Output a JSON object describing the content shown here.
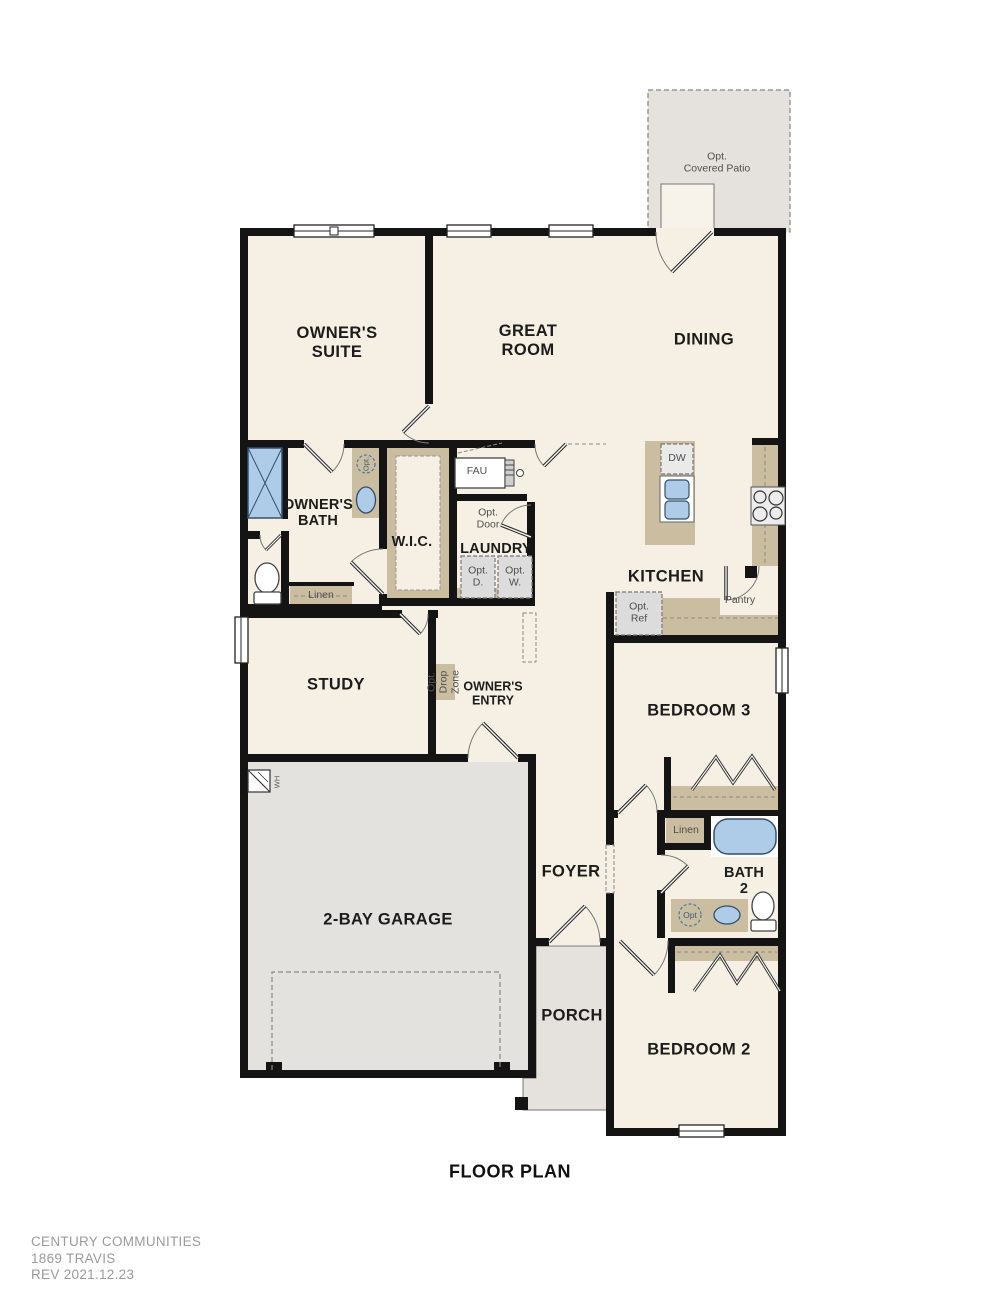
{
  "title": {
    "floor_plan": "FLOOR PLAN"
  },
  "footer": {
    "company": "CENTURY COMMUNITIES",
    "plan": "1869 TRAVIS",
    "rev": "REV  2021.12.23"
  },
  "rooms": {
    "patio": "Opt.\nCovered Patio",
    "owners_suite": "OWNER'S\nSUITE",
    "great_room": "GREAT\nROOM",
    "dining": "DINING",
    "owners_bath": "OWNER'S\nBATH",
    "wic": "W.I.C.",
    "laundry": "LAUNDRY",
    "kitchen": "KITCHEN",
    "study": "STUDY",
    "owners_entry": "OWNER'S\nENTRY",
    "bedroom3": "BEDROOM 3",
    "foyer": "FOYER",
    "bath2": "BATH\n2",
    "garage": "2-BAY GARAGE",
    "porch": "PORCH",
    "bedroom2": "BEDROOM 2"
  },
  "fixtures": {
    "fau": "FAU",
    "opt_door": "Opt.\nDoor",
    "opt_dryer": "Opt.\nD.",
    "opt_washer": "Opt.\nW.",
    "linen_owners": "Linen",
    "linen_bath2": "Linen",
    "dw": "DW",
    "pantry": "Pantry",
    "opt_ref": "Opt.\nRef",
    "opt_drop_zone": "Opt.\nDrop\nZone",
    "opt_sink_owners": "Opt.",
    "opt_sink_bath2": "Opt",
    "water_heater": "WH"
  },
  "colors": {
    "floor": "#f6f0e4",
    "exterior_concrete": "#e5e2dd",
    "wall": "#141414",
    "cabinet_tan": "#cbbd9f",
    "fixture_blue": "#aecbe8",
    "optional_gray": "#dcdcdc"
  }
}
